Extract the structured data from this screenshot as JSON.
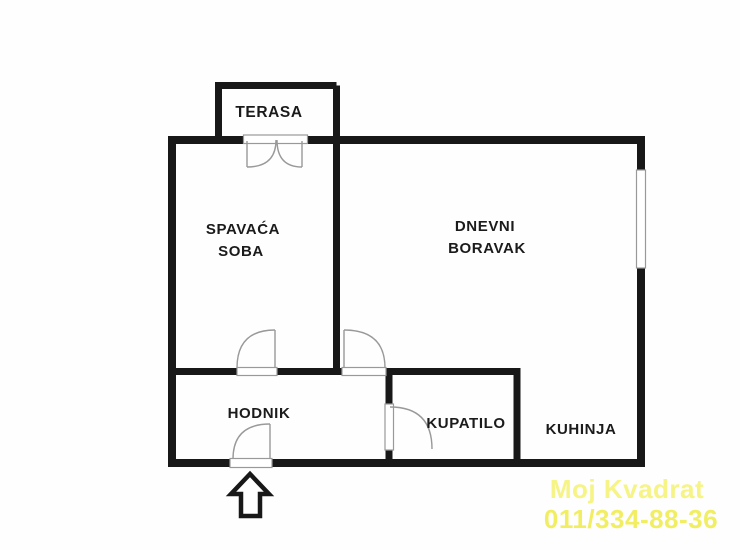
{
  "floorplan": {
    "rooms": {
      "terasa": {
        "label": "TERASA"
      },
      "spavaca_soba": {
        "line1": "SPAVAĆA",
        "line2": "SOBA"
      },
      "dnevni_boravak": {
        "line1": "DNEVNI",
        "line2": "BORAVAK"
      },
      "hodnik": {
        "label": "HODNIK"
      },
      "kupatilo": {
        "label": "KUPATILO"
      },
      "kuhinja": {
        "label": "KUHINJA"
      }
    },
    "colors": {
      "wall": "#181818",
      "door_symbol": "#999999",
      "background": "#fefefe"
    },
    "icons": {
      "entrance_arrow": "up-arrow"
    }
  },
  "watermark": {
    "company": "Moj Kvadrat",
    "phone": "011/334-88-36",
    "company_color": "#f5f484",
    "phone_color": "#f1ee62"
  }
}
